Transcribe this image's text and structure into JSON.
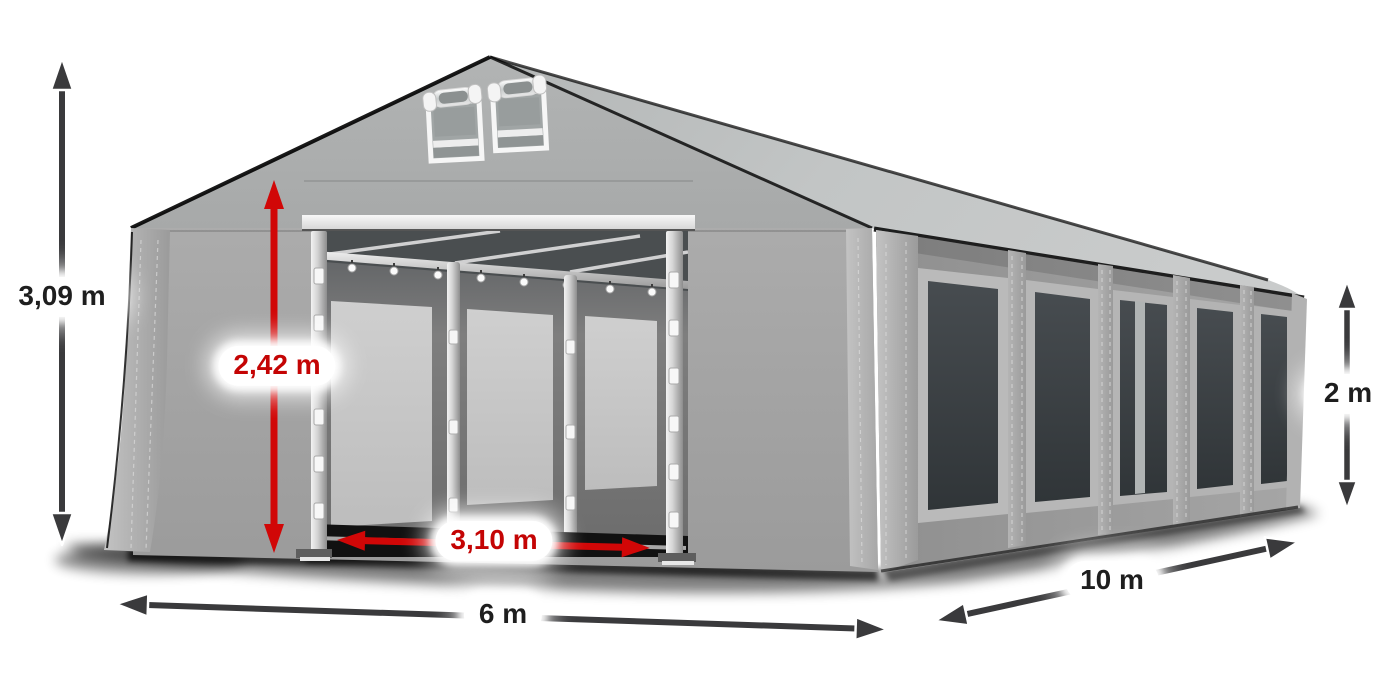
{
  "page": {
    "background": "#ffffff",
    "subject": "party tent dimension illustration"
  },
  "colors": {
    "arrow_dark": "#3a3a3c",
    "arrow_red": "#d10707",
    "label_text_dark": "#1e1e1e",
    "label_text_red": "#c40404",
    "label_background": "#ffffff",
    "tent_fabric_gray": "#a6a6a6",
    "roof_gray": "#c0c3c3",
    "window_glass": "#3c4144",
    "frame_silver": "#d8d8d8",
    "shadow": "#0a0a0a"
  },
  "measurements": {
    "total_height": {
      "label": "3,09 m"
    },
    "entrance_height": {
      "label": "2,42 m"
    },
    "entrance_width": {
      "label": "3,10 m"
    },
    "front_width": {
      "label": "6 m"
    },
    "side_length": {
      "label": "10 m"
    },
    "side_wall_height": {
      "label": "2 m"
    }
  }
}
